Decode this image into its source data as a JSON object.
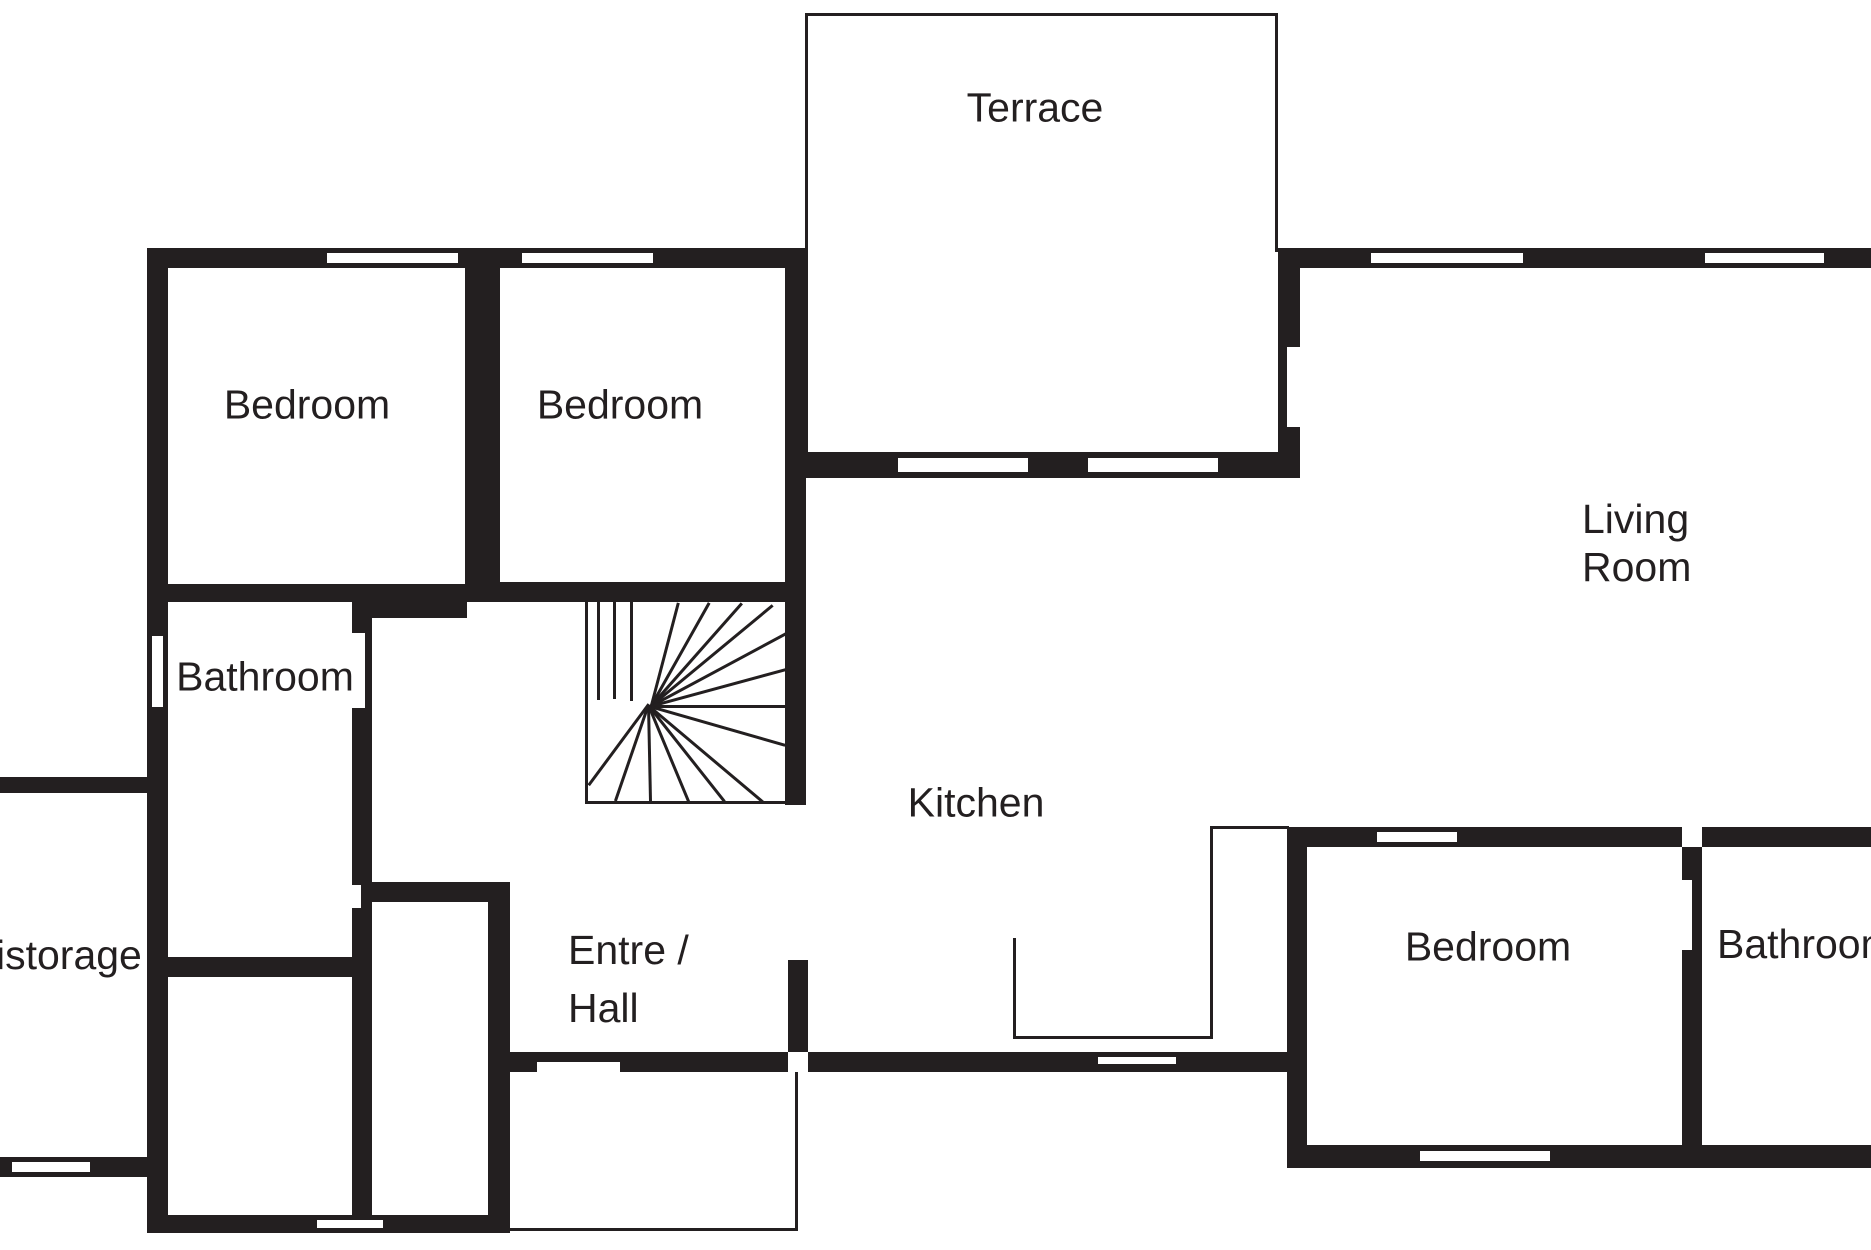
{
  "canvas": {
    "width": 1871,
    "height": 1250
  },
  "colors": {
    "wall": "#231f20",
    "background": "#ffffff"
  },
  "rooms": {
    "labels": [
      {
        "id": "terrace",
        "text": "Terrace",
        "x": 1035,
        "y": 108,
        "align": "center"
      },
      {
        "id": "bedroom-1",
        "text": "Bedroom",
        "x": 307,
        "y": 405,
        "align": "center"
      },
      {
        "id": "bedroom-2",
        "text": "Bedroom",
        "x": 620,
        "y": 405,
        "align": "center"
      },
      {
        "id": "living-room",
        "text": "Living\nRoom",
        "x": 1582,
        "y": 495,
        "align": "left",
        "line_height": "1.18"
      },
      {
        "id": "bathroom-left",
        "text": "Bathroom",
        "x": 265,
        "y": 677,
        "align": "center"
      },
      {
        "id": "storage",
        "text": "istorage",
        "x": -4,
        "y": 932,
        "align": "left"
      },
      {
        "id": "kitchen",
        "text": "Kitchen",
        "x": 976,
        "y": 803,
        "align": "center"
      },
      {
        "id": "entre-hall",
        "text": "Entre /\nHall",
        "x": 568,
        "y": 921,
        "align": "left",
        "line_height": "1.42"
      },
      {
        "id": "bedroom-3",
        "text": "Bedroom",
        "x": 1488,
        "y": 947,
        "align": "center"
      },
      {
        "id": "bathroom-right",
        "text": "Bathroom",
        "x": 1717,
        "y": 921,
        "align": "left"
      }
    ]
  },
  "structure": {
    "walls": [
      {
        "id": "bedrooms-top",
        "x": 147,
        "y": 248,
        "w": 659,
        "h": 20
      },
      {
        "id": "outer-left",
        "x": 147,
        "y": 248,
        "w": 21,
        "h": 985
      },
      {
        "id": "bedroom-divider",
        "x": 465,
        "y": 268,
        "w": 35,
        "h": 316
      },
      {
        "id": "bedrooms-bottom-1",
        "x": 147,
        "y": 584,
        "w": 225,
        "h": 18
      },
      {
        "id": "bedrooms-bottom-2",
        "x": 372,
        "y": 584,
        "w": 95,
        "h": 34
      },
      {
        "id": "bedrooms-bottom-3",
        "x": 467,
        "y": 582,
        "w": 339,
        "h": 20
      },
      {
        "id": "bedroom2-right",
        "x": 785,
        "y": 268,
        "w": 21,
        "h": 537
      },
      {
        "id": "terrace-bottom",
        "x": 785,
        "y": 452,
        "w": 515,
        "h": 26
      },
      {
        "id": "terrace-living",
        "x": 1278,
        "y": 250,
        "w": 22,
        "h": 228
      },
      {
        "id": "living-top",
        "x": 1278,
        "y": 248,
        "w": 593,
        "h": 20
      },
      {
        "id": "bathroom-right-wall",
        "x": 352,
        "y": 600,
        "w": 20,
        "h": 615
      },
      {
        "id": "corridor-wall",
        "x": 372,
        "y": 882,
        "w": 138,
        "h": 20
      },
      {
        "id": "hall-left-wall",
        "x": 488,
        "y": 902,
        "w": 22,
        "h": 331
      },
      {
        "id": "storage-top",
        "x": 0,
        "y": 777,
        "w": 147,
        "h": 16
      },
      {
        "id": "storage-bottom",
        "x": 0,
        "y": 1157,
        "w": 152,
        "h": 20
      },
      {
        "id": "outer-bottom-left",
        "x": 147,
        "y": 1215,
        "w": 358,
        "h": 18
      },
      {
        "id": "bathroom-bottom",
        "x": 168,
        "y": 957,
        "w": 204,
        "h": 20
      },
      {
        "id": "hall-bottom-left",
        "x": 490,
        "y": 1052,
        "w": 298,
        "h": 20
      },
      {
        "id": "hall-bottom-right",
        "x": 808,
        "y": 1052,
        "w": 499,
        "h": 20
      },
      {
        "id": "door-jamb-stub",
        "x": 788,
        "y": 960,
        "w": 20,
        "h": 92
      },
      {
        "id": "bedroom3-left",
        "x": 1287,
        "y": 827,
        "w": 20,
        "h": 341
      },
      {
        "id": "bedroom3-top",
        "x": 1287,
        "y": 827,
        "w": 395,
        "h": 20
      },
      {
        "id": "bedroom3-bath-div",
        "x": 1682,
        "y": 847,
        "w": 20,
        "h": 298
      },
      {
        "id": "bathroom-right-top",
        "x": 1702,
        "y": 827,
        "w": 169,
        "h": 20
      },
      {
        "id": "outer-bottom-right",
        "x": 1287,
        "y": 1145,
        "w": 584,
        "h": 23
      }
    ],
    "windows": [
      {
        "id": "win-bed1",
        "orient": "h",
        "x": 327,
        "y": 250,
        "w": 131,
        "h": 16
      },
      {
        "id": "win-bed2",
        "orient": "h",
        "x": 522,
        "y": 250,
        "w": 131,
        "h": 16
      },
      {
        "id": "win-living-1",
        "orient": "h",
        "x": 1371,
        "y": 250,
        "w": 152,
        "h": 16
      },
      {
        "id": "win-living-2",
        "orient": "h",
        "x": 1705,
        "y": 250,
        "w": 119,
        "h": 16
      },
      {
        "id": "win-terrace-1",
        "orient": "h",
        "x": 898,
        "y": 455,
        "w": 130,
        "h": 20
      },
      {
        "id": "win-terrace-2",
        "orient": "h",
        "x": 1088,
        "y": 455,
        "w": 130,
        "h": 20
      },
      {
        "id": "win-bathroom",
        "orient": "v",
        "x": 149,
        "y": 636,
        "w": 17,
        "h": 71
      },
      {
        "id": "win-kitchen",
        "orient": "h",
        "x": 1098,
        "y": 1054,
        "w": 78,
        "h": 13
      },
      {
        "id": "win-bed3-top",
        "orient": "h",
        "x": 1377,
        "y": 829,
        "w": 80,
        "h": 16
      },
      {
        "id": "win-bed3-bottom",
        "orient": "h",
        "x": 1420,
        "y": 1148,
        "w": 130,
        "h": 16
      },
      {
        "id": "win-storage",
        "orient": "h",
        "x": 12,
        "y": 1159,
        "w": 78,
        "h": 16
      },
      {
        "id": "win-bottom-left",
        "orient": "h",
        "x": 317,
        "y": 1217,
        "w": 66,
        "h": 14
      }
    ],
    "openings": [
      {
        "id": "door-terrace",
        "x": 1287,
        "y": 347,
        "w": 13,
        "h": 80
      },
      {
        "id": "door-bathroom",
        "x": 352,
        "y": 633,
        "w": 13,
        "h": 75
      },
      {
        "id": "door-bathroom-2",
        "x": 352,
        "y": 885,
        "w": 9,
        "h": 23
      },
      {
        "id": "door-hall",
        "x": 537,
        "y": 1062,
        "w": 83,
        "h": 10
      },
      {
        "id": "door-bathroom-right",
        "x": 1682,
        "y": 880,
        "w": 10,
        "h": 70
      }
    ],
    "thin_lines": [
      {
        "id": "terrace-top",
        "x": 806,
        "y": 13,
        "w": 472,
        "h": 3
      },
      {
        "id": "terrace-left",
        "x": 805,
        "y": 13,
        "w": 3,
        "h": 441
      },
      {
        "id": "terrace-right",
        "x": 1275,
        "y": 13,
        "w": 3,
        "h": 239
      },
      {
        "id": "nook-right",
        "x": 1210,
        "y": 826,
        "w": 3,
        "h": 213
      },
      {
        "id": "nook-bottom",
        "x": 1013,
        "y": 1036,
        "w": 200,
        "h": 3
      },
      {
        "id": "nook-stub",
        "x": 1013,
        "y": 938,
        "w": 3,
        "h": 101
      },
      {
        "id": "nook-connector",
        "x": 1210,
        "y": 826,
        "w": 79,
        "h": 3
      },
      {
        "id": "porch-right",
        "x": 795,
        "y": 1072,
        "w": 3,
        "h": 159
      },
      {
        "id": "porch-bottom",
        "x": 508,
        "y": 1228,
        "w": 290,
        "h": 3
      },
      {
        "id": "stairs-left",
        "x": 585,
        "y": 602,
        "w": 3,
        "h": 202
      },
      {
        "id": "stairs-bottom",
        "x": 585,
        "y": 801,
        "w": 203,
        "h": 3
      }
    ],
    "stair_treads": [
      [
        600,
        602,
        600,
        700
      ],
      [
        616,
        602,
        616,
        699
      ],
      [
        633,
        602,
        633,
        701
      ],
      [
        650,
        705,
        677,
        602
      ],
      [
        650,
        705,
        708,
        602
      ],
      [
        650,
        705,
        741,
        602
      ],
      [
        650,
        705,
        772,
        604
      ],
      [
        650,
        705,
        786,
        632
      ],
      [
        650,
        705,
        786,
        668
      ],
      [
        650,
        705,
        786,
        705
      ],
      [
        650,
        705,
        786,
        744
      ],
      [
        650,
        705,
        764,
        801
      ],
      [
        650,
        705,
        726,
        801
      ],
      [
        650,
        705,
        690,
        801
      ],
      [
        650,
        705,
        652,
        801
      ],
      [
        650,
        705,
        617,
        801
      ],
      [
        650,
        705,
        590,
        786
      ]
    ]
  }
}
